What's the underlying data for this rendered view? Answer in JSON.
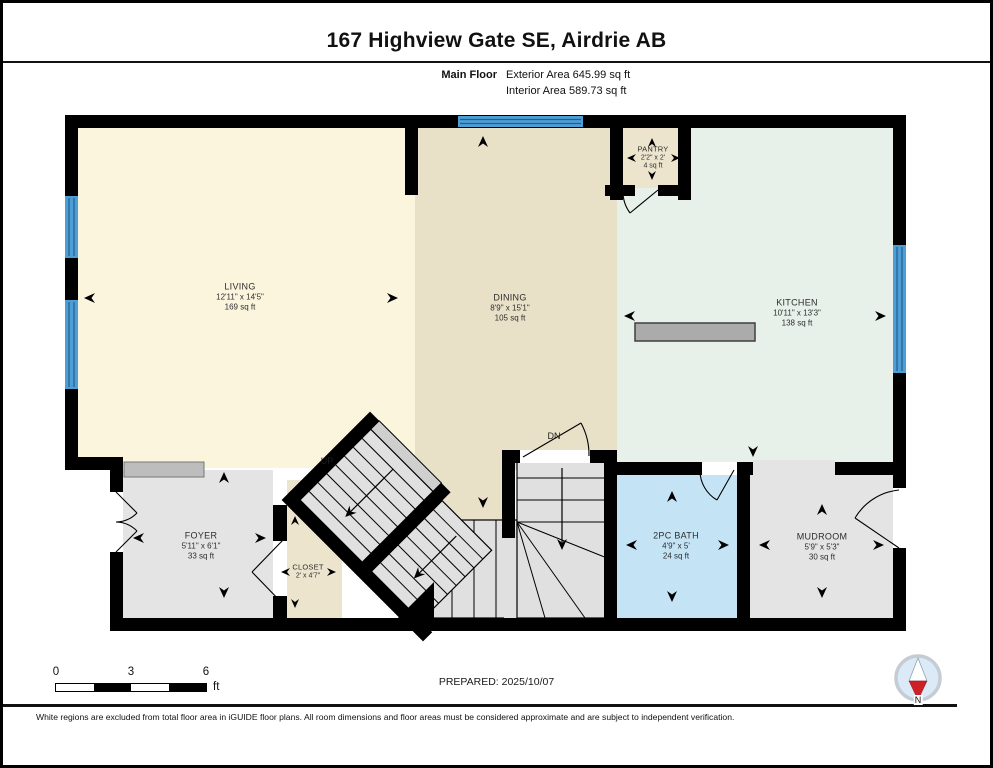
{
  "header": {
    "title": "167 Highview Gate SE, Airdrie AB",
    "floor_label": "Main Floor",
    "exterior_area": "Exterior Area 645.99 sq ft",
    "interior_area": "Interior Area 589.73 sq ft"
  },
  "rooms": [
    {
      "name": "LIVING",
      "dimensions": "12'11\" x 14'5\"",
      "area": "169 sq ft"
    },
    {
      "name": "DINING",
      "dimensions": "8'9\" x 15'1\"",
      "area": "105 sq ft"
    },
    {
      "name": "KITCHEN",
      "dimensions": "10'11\" x 13'3\"",
      "area": "138 sq ft"
    },
    {
      "name": "PANTRY",
      "dimensions": "2'2\" x 2'",
      "area": "4 sq ft"
    },
    {
      "name": "FOYER",
      "dimensions": "5'11\" x 6'1\"",
      "area": "33 sq ft"
    },
    {
      "name": "CLOSET",
      "dimensions": "2' x 4'7\""
    },
    {
      "name": "2PC BATH",
      "dimensions": "4'9\" x 5'",
      "area": "24 sq ft"
    },
    {
      "name": "MUDROOM",
      "dimensions": "5'9\" x 5'3\"",
      "area": "30 sq ft"
    }
  ],
  "stairs": {
    "up_label": "UP",
    "down_label": "DN"
  },
  "scale_bar": {
    "ticks": [
      "0",
      "3",
      "6"
    ],
    "unit": "ft"
  },
  "footer": {
    "prepared": "PREPARED: 2025/10/07",
    "compass_label": "N",
    "disclaimer": "White regions are excluded from total floor area in iGUIDE floor plans. All room dimensions and floor areas must be considered approximate and are subject to independent verification."
  },
  "colors": {
    "living": "#FBF5DE",
    "dining": "#E9E0C8",
    "kitchen": "#E7F0E9",
    "pantry": "#EDE4CE",
    "closet": "#EDE4CE",
    "bath": "#C4E4F6",
    "gray_floor": "#E4E4E4",
    "stair_gray": "#E0E0E0",
    "wall": "#000000",
    "window": "#4E9ED6",
    "window_line": "#205E8F",
    "counter": "#ABABAB",
    "needle_red": "#CE2127"
  }
}
